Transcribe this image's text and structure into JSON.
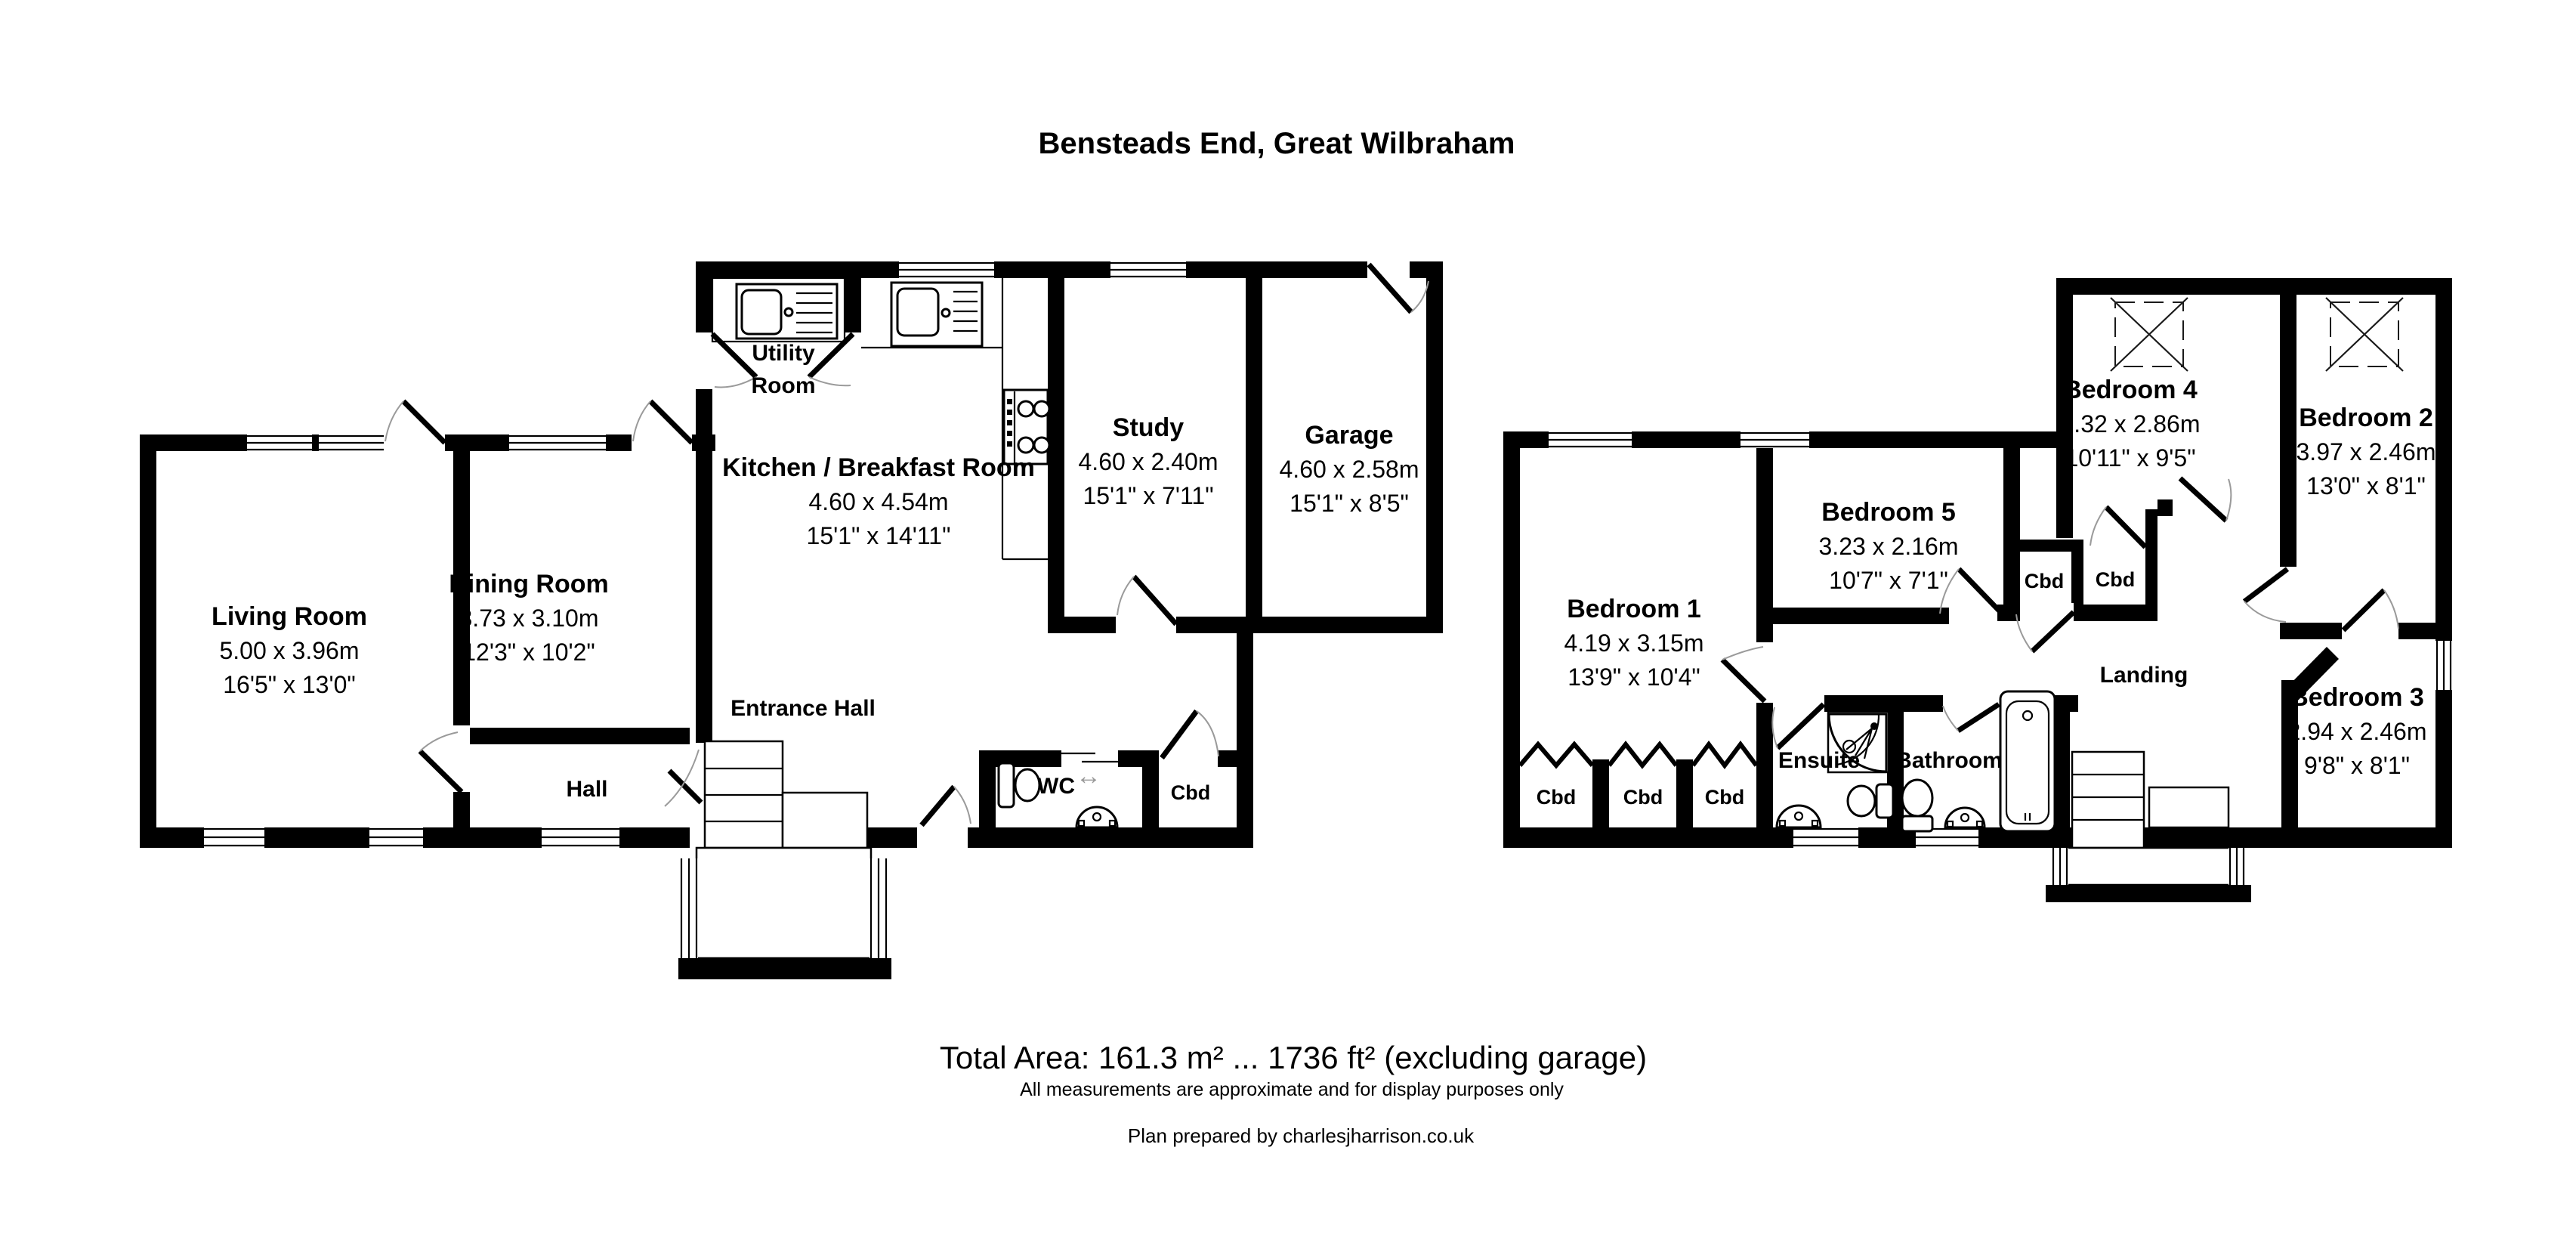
{
  "title": "Bensteads End, Great Wilbraham",
  "footer": {
    "total_area": "Total Area: 161.3 m² ... 1736 ft² (excluding garage)",
    "disclaimer": "All measurements are approximate and for display purposes only",
    "credit": "Plan prepared by charlesjharrison.co.uk"
  },
  "labels": {
    "closet": "Cbd"
  },
  "icons": {
    "sliding_door": "↔"
  },
  "colors": {
    "wall": "#000000",
    "background": "#ffffff",
    "door_arc": "#9a9a9a"
  },
  "ground_floor": {
    "rooms": [
      {
        "name": "Living Room",
        "metric": "5.00 x 3.96m",
        "imperial": "16'5\" x 13'0\""
      },
      {
        "name": "Dining Room",
        "metric": "3.73 x 3.10m",
        "imperial": "12'3\" x 10'2\""
      },
      {
        "name": "Utility Room"
      },
      {
        "name": "Kitchen / Breakfast Room",
        "metric": "4.60 x 4.54m",
        "imperial": "15'1\" x 14'11\""
      },
      {
        "name": "Study",
        "metric": "4.60 x 2.40m",
        "imperial": "15'1\" x 7'11\""
      },
      {
        "name": "Garage",
        "metric": "4.60 x 2.58m",
        "imperial": "15'1\" x 8'5\""
      },
      {
        "name": "Entrance Hall"
      },
      {
        "name": "Hall"
      },
      {
        "name": "WC"
      }
    ]
  },
  "first_floor": {
    "rooms": [
      {
        "name": "Bedroom 1",
        "metric": "4.19 x 3.15m",
        "imperial": "13'9\" x 10'4\""
      },
      {
        "name": "Bedroom 5",
        "metric": "3.23 x 2.16m",
        "imperial": "10'7\" x 7'1\""
      },
      {
        "name": "Bedroom 4",
        "metric": "3.32 x 2.86m",
        "imperial": "10'11\" x 9'5\""
      },
      {
        "name": "Bedroom 2",
        "metric": "3.97 x 2.46m",
        "imperial": "13'0\" x 8'1\""
      },
      {
        "name": "Bedroom 3",
        "metric": "2.94 x 2.46m",
        "imperial": "9'8\" x 8'1\""
      },
      {
        "name": "Ensuite"
      },
      {
        "name": "Bathroom"
      },
      {
        "name": "Landing"
      }
    ]
  }
}
